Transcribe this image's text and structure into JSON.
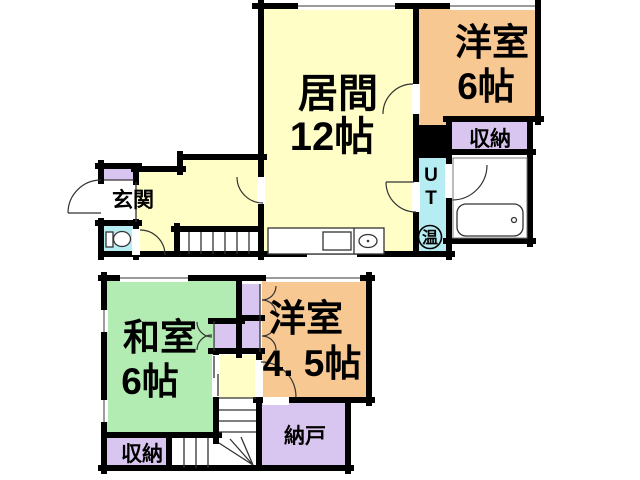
{
  "colors": {
    "wall": "#000000",
    "room_yellow": "#FEFEC6",
    "room_orange": "#F8C893",
    "room_green": "#B2ECB2",
    "closet_purple": "#D9C6F0",
    "water_blue": "#B6EDF2",
    "white": "#FFFFFF"
  },
  "floor1": {
    "living": {
      "name": "居間",
      "size": "12帖"
    },
    "western6": {
      "name": "洋室",
      "size": "6帖"
    },
    "storage_label": "収納",
    "entrance_label": "玄関",
    "utility": {
      "line1": "U",
      "line2": "T",
      "heater": "温"
    }
  },
  "floor2": {
    "japanese": {
      "name": "和室",
      "size": "6帖"
    },
    "western45": {
      "name": "洋室",
      "size": "4. 5帖"
    },
    "nando_label": "納戸",
    "storage_label": "収納"
  }
}
